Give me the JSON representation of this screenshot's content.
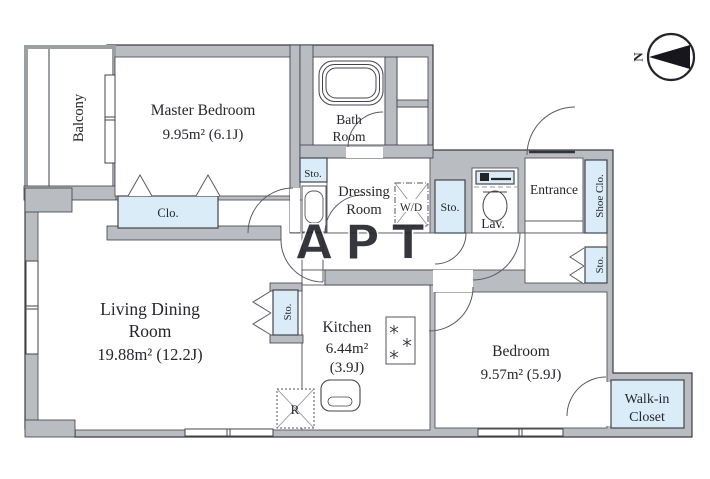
{
  "plan": {
    "watermark": "APT",
    "north_label": "N",
    "rooms": {
      "balcony": {
        "label": "Balcony"
      },
      "master_bedroom": {
        "name": "Master Bedroom",
        "area": "9.95m² (6.1J)"
      },
      "bath": {
        "name_line1": "Bath",
        "name_line2": "Room"
      },
      "dressing": {
        "name_line1": "Dressing",
        "name_line2": "Room"
      },
      "living_dining": {
        "name_line1": "Living Dining",
        "name_line2": "Room",
        "area": "19.88m²  (12.2J)"
      },
      "kitchen": {
        "name": "Kitchen",
        "area_line1": "6.44m²",
        "area_line2": "(3.9J)"
      },
      "bedroom": {
        "name": "Bedroom",
        "area": "9.57m² (5.9J)"
      },
      "walk_in_closet": {
        "name_line1": "Walk-in",
        "name_line2": "Closet"
      },
      "entrance": {
        "name": "Entrance"
      },
      "lavatory": {
        "name": "Lav."
      }
    },
    "storage": {
      "closet": "Clo.",
      "sto_dressing": "Sto.",
      "sto_hall": "Sto.",
      "sto_entry": "Sto.",
      "sto_kitchen": "Sto.",
      "shoe_closet": "Shoe Clo.",
      "washer_dryer": "W/D",
      "refrigerator": "R"
    },
    "colors": {
      "wall": "#b9bcc0",
      "storage_fill": "#d9ecf7",
      "line": "#3c3c46",
      "watermark": "#ccd3db"
    }
  }
}
